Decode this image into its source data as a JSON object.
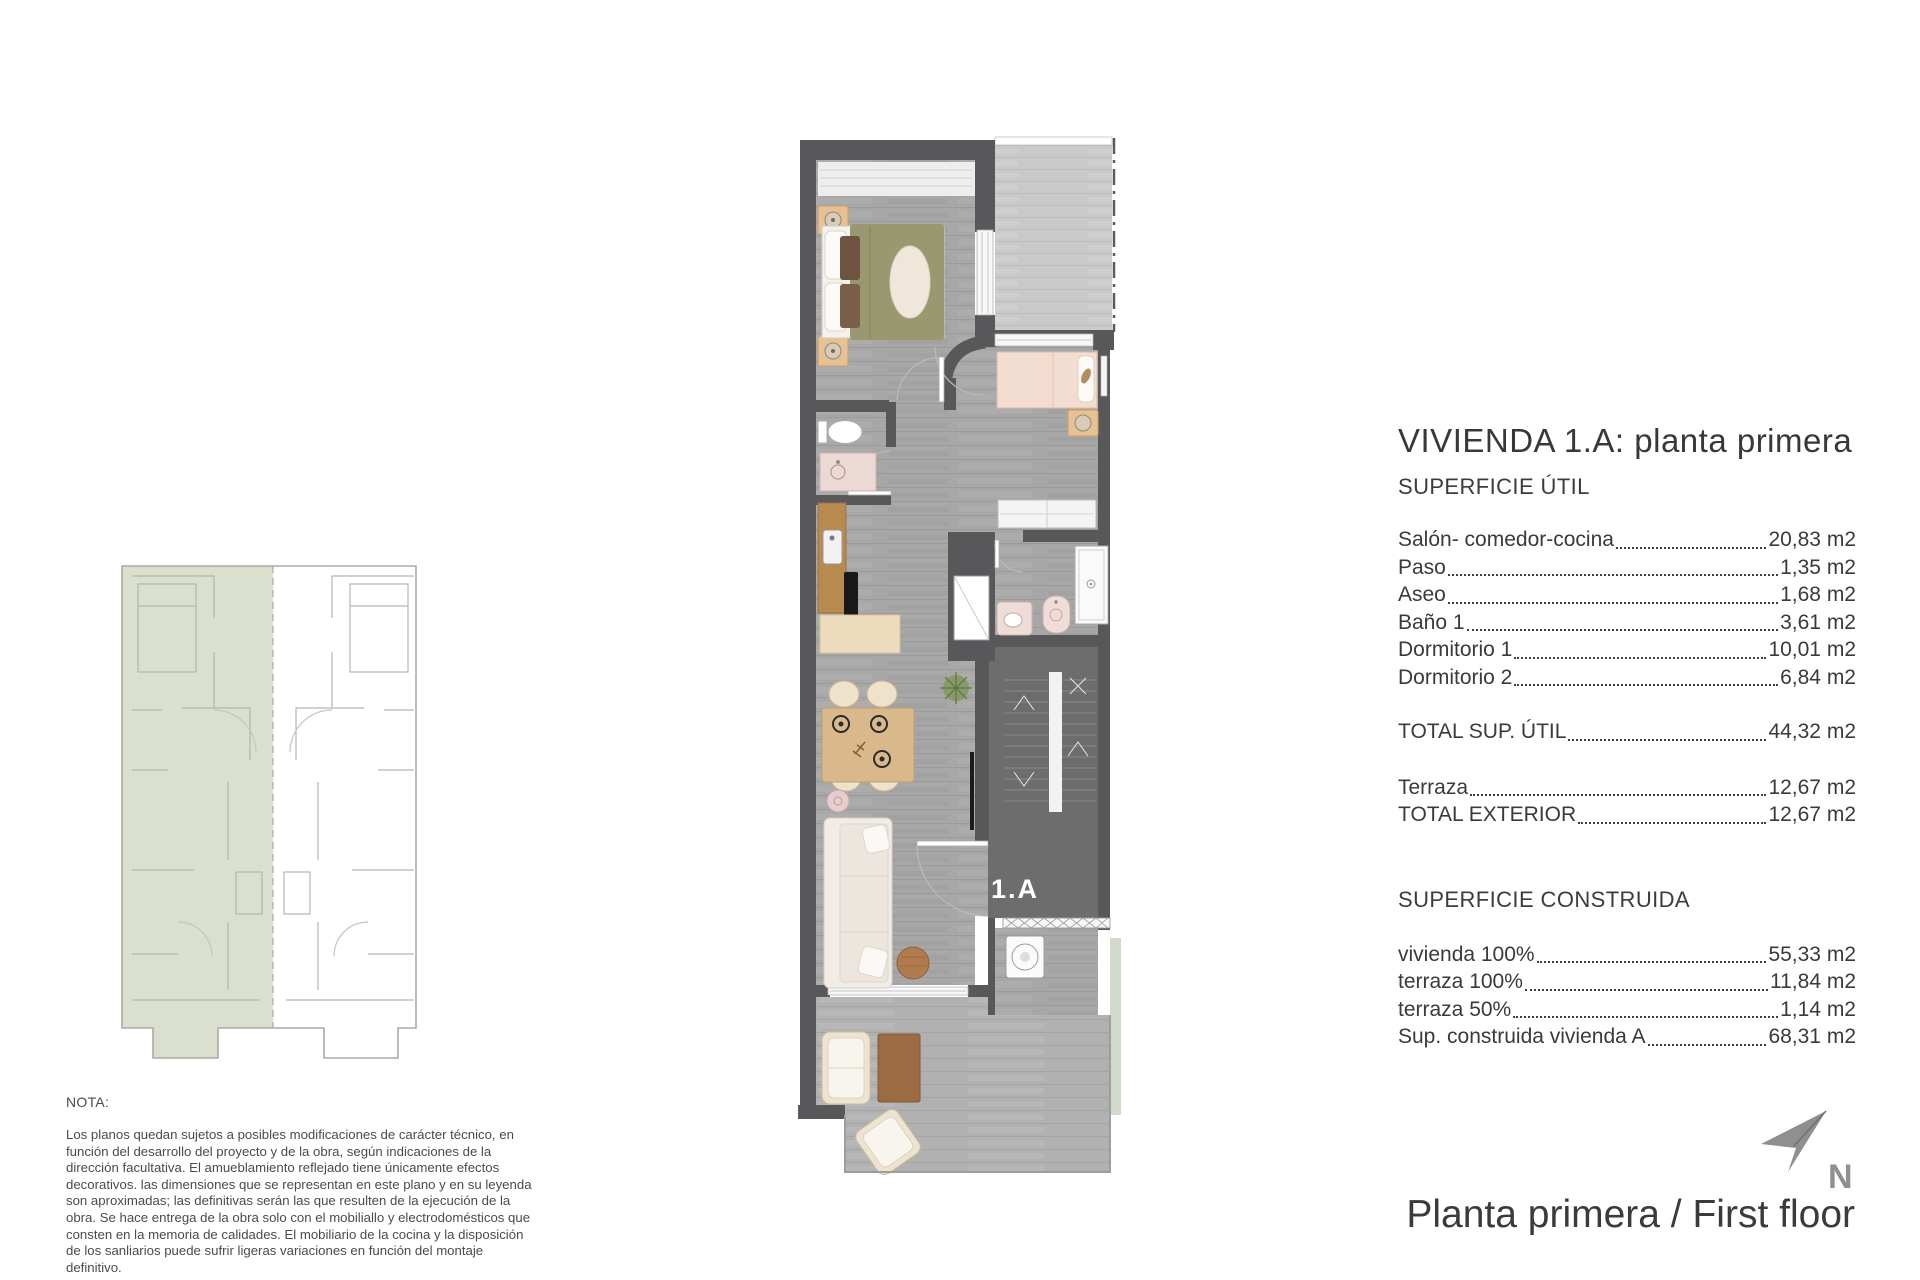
{
  "title_block": {
    "title": "VIVIENDA 1.A: planta primera",
    "useful_area": {
      "heading": "SUPERFICIE ÚTIL",
      "rows": [
        {
          "label": "Salón- comedor-cocina",
          "value": "20,83 m2"
        },
        {
          "label": "Paso",
          "value": "1,35 m2"
        },
        {
          "label": "Aseo",
          "value": "1,68 m2"
        },
        {
          "label": "Baño 1",
          "value": "3,61 m2"
        },
        {
          "label": "Dormitorio 1",
          "value": "10,01 m2"
        },
        {
          "label": "Dormitorio 2",
          "value": "6,84 m2"
        }
      ],
      "total": {
        "label": "TOTAL SUP. ÚTIL",
        "value": "44,32 m2"
      },
      "exterior_rows": [
        {
          "label": "Terraza",
          "value": "12,67 m2"
        },
        {
          "label": "TOTAL EXTERIOR",
          "value": "12,67 m2"
        }
      ]
    },
    "built_area": {
      "heading": "SUPERFICIE CONSTRUIDA",
      "rows": [
        {
          "label": "vivienda 100%",
          "value": "55,33 m2"
        },
        {
          "label": "terraza 100%",
          "value": "11,84 m2"
        },
        {
          "label": "terraza 50%",
          "value": "1,14 m2"
        },
        {
          "label": "Sup. construida vivienda A",
          "value": "68,31 m2"
        }
      ]
    }
  },
  "note": {
    "heading": "NOTA:",
    "body": "Los planos quedan sujetos a posibles modificaciones de carácter técnico, en función del desarrollo del proyecto y de la obra, según indicaciones de la dirección facultativa. El amueblamiento reflejado tiene únicamente efectos decorativos. las dimensiones que se representan en este plano y en su leyenda son aproximadas; las definitivas serán las que resulten de la ejecución de la obra. Se hace entrega de la obra solo con el mobiliallo y electrodomésticos que consten en la memoria de calidades. El mobiliario de la cocina y la disposición de los sanliarios puede sufrir ligeras variaciones en función del montaje definitivo."
  },
  "plan": {
    "unit_label": "1.A"
  },
  "footer": {
    "floor_label": "Planta primera / First floor",
    "north_label": "N"
  },
  "colors": {
    "wall": "#58585a",
    "interior_floor": "#a7a7a7",
    "upper_terrace_floor": "#c9c9c9",
    "lower_terrace_floor": "#b1b1b1",
    "stair_floor": "#6d6d6d",
    "key_plan_highlight": "#dae0cd",
    "duvet_olive": "#9a9870",
    "bed_pink": "#f2ddd0",
    "text_dark": "#3c3c3c",
    "north_gray": "#8f8f8f"
  }
}
